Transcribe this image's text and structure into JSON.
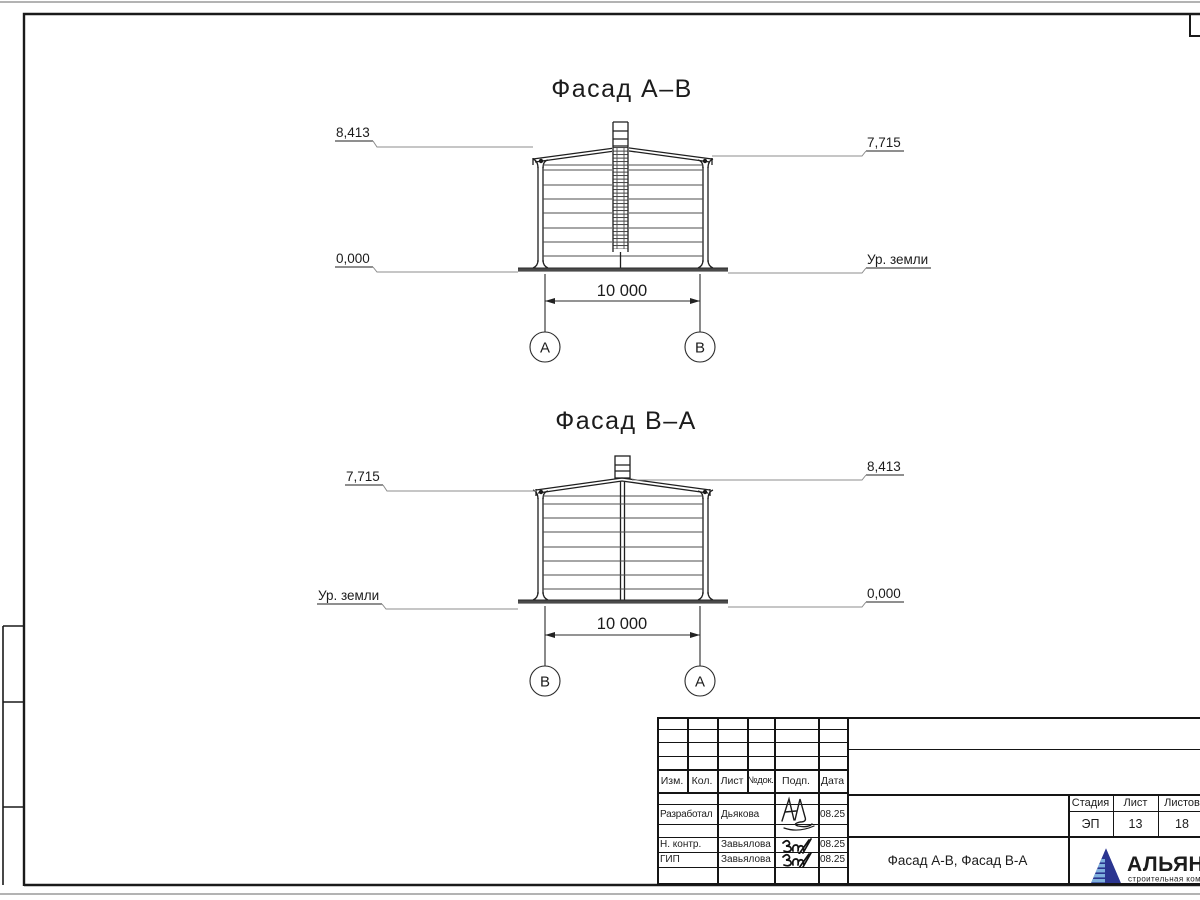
{
  "facades": [
    {
      "title": "Фасад А–В",
      "elev_left_top": "8,413",
      "elev_left_bottom": "0,000",
      "elev_right_top": "7,715",
      "elev_right_bottom": "Ур. земли",
      "dim": "10 000",
      "axis_left": "А",
      "axis_right": "В"
    },
    {
      "title": "Фасад В–А",
      "elev_left_top": "7,715",
      "elev_left_bottom": "Ур. земли",
      "elev_right_top": "8,413",
      "elev_right_bottom": "0,000",
      "dim": "10 000",
      "axis_left": "В",
      "axis_right": "А"
    }
  ],
  "titleblock": {
    "cols": {
      "izm": "Изм.",
      "kol": "Кол.",
      "list": "Лист",
      "doc": "№док.",
      "sign": "Подп.",
      "date": "Дата"
    },
    "row_developed": {
      "role": "Разработал",
      "name": "Дьякова",
      "date": "08.25"
    },
    "row_ncontr": {
      "role": "Н. контр.",
      "name": "Завьялова",
      "date": "08.25"
    },
    "row_gip": {
      "role": "ГИП",
      "name": "Завьялова",
      "date": "08.25"
    },
    "stage_header": "Стадия",
    "list_header": "Лист",
    "listov_header": "Листов",
    "stage": "ЭП",
    "list": "13",
    "listov": "18",
    "doc_title": "Фасад А-В, Фасад В-А"
  },
  "logo": {
    "name": "АЛЬЯНС",
    "subtitle": "строительная компания",
    "color_navy": "#2b3590",
    "color_stripe": "#7fb0dd",
    "color_subtitle": "#5b82c8"
  }
}
